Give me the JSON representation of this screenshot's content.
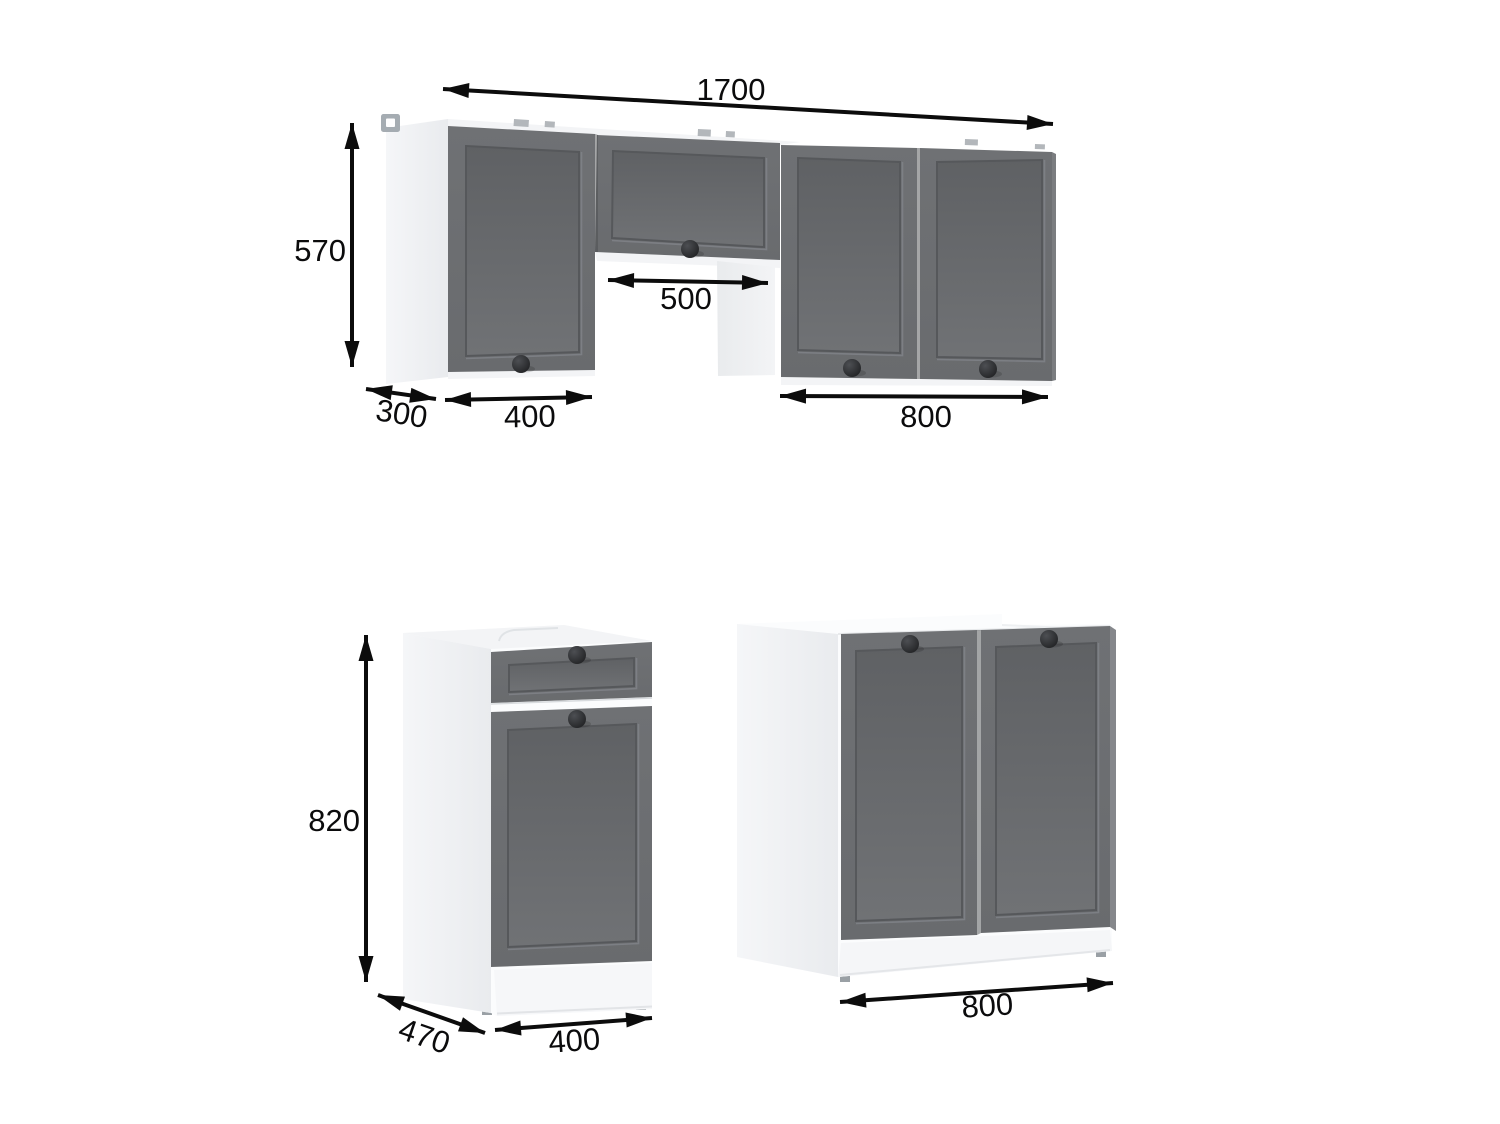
{
  "diagram": {
    "title": "kitchen-cabinet-set-dimension-drawing",
    "colors": {
      "door_front": "#6a6c6f",
      "carcass_white": "#fbfcfd",
      "arrow": "#0c0c0c",
      "knob": "#212225"
    },
    "wall_cabinets": {
      "dims": {
        "total_width": "1700",
        "height": "570",
        "depth": "300",
        "left_cabinet_width": "400",
        "hood_gap_width": "500",
        "right_cabinet_width": "800"
      }
    },
    "base_cabinets": {
      "left_cabinet": {
        "dims": {
          "height": "820",
          "depth": "470",
          "width": "400"
        }
      },
      "sink_cabinet": {
        "dims": {
          "width": "800"
        }
      }
    }
  }
}
